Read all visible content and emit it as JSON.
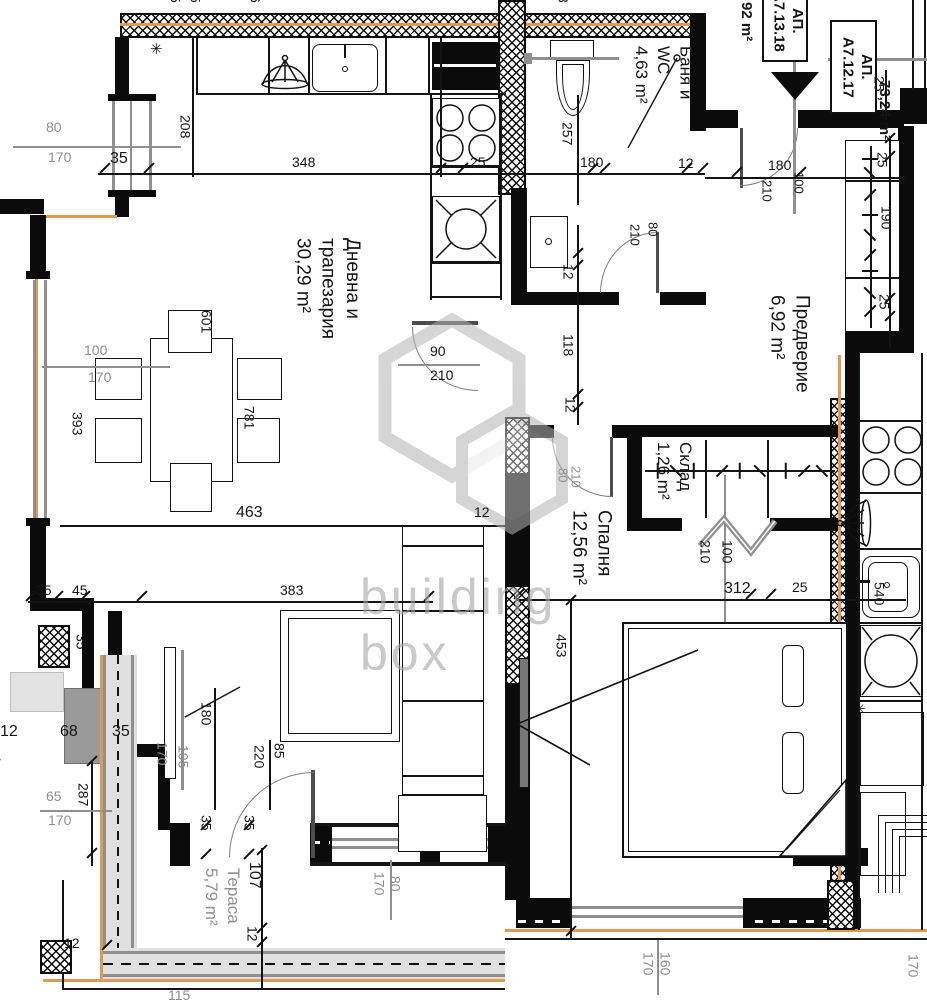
{
  "watermark": {
    "line1": "building",
    "line2": "box"
  },
  "apartments": {
    "neighbor": {
      "label_prefix": "АП.",
      "label_code": "А7.13.18",
      "area": "92 m²"
    },
    "current": {
      "label_prefix": "АП.",
      "label_code": "А7.12.17",
      "area": "73,24 m²"
    }
  },
  "rooms": {
    "living": {
      "line1": "Дневна и",
      "line2": "трапезария",
      "area": "30,29 m²"
    },
    "bath": {
      "line1": "Баня и",
      "line2": "WC",
      "area": "4,63 m²"
    },
    "hall": {
      "line1": "Предверие",
      "area": "6,92 m²"
    },
    "bedroom": {
      "line1": "Спалня",
      "area": "12,56 m²"
    },
    "storage": {
      "line1": "Склад",
      "area": "1,26 m²"
    },
    "terrace": {
      "line1": "Тераса",
      "area": "5,79 m²"
    },
    "neighbor_partial": "Хол с готварня"
  },
  "symbols": {
    "asterisk": "✳"
  },
  "dims": [
    "80",
    "170",
    "35",
    "208",
    "348",
    "25",
    "257",
    "180",
    "12",
    "180",
    "210",
    "100",
    "25",
    "25",
    "190",
    "25",
    "90",
    "210",
    "12",
    "118",
    "12",
    "210",
    "80",
    "601",
    "100",
    "170",
    "393",
    "781",
    "463",
    "12",
    "35",
    "45",
    "383",
    "312",
    "25",
    "453",
    "210",
    "100",
    "540",
    "80",
    "210",
    "35",
    "12",
    "68",
    "35",
    "180",
    "170",
    "105",
    "65",
    "170",
    "287",
    "220",
    "85",
    "35",
    "35",
    "107",
    "12",
    "170",
    "80",
    "12",
    "170",
    "160",
    "170",
    "115",
    "5",
    "5",
    "6",
    "8"
  ]
}
